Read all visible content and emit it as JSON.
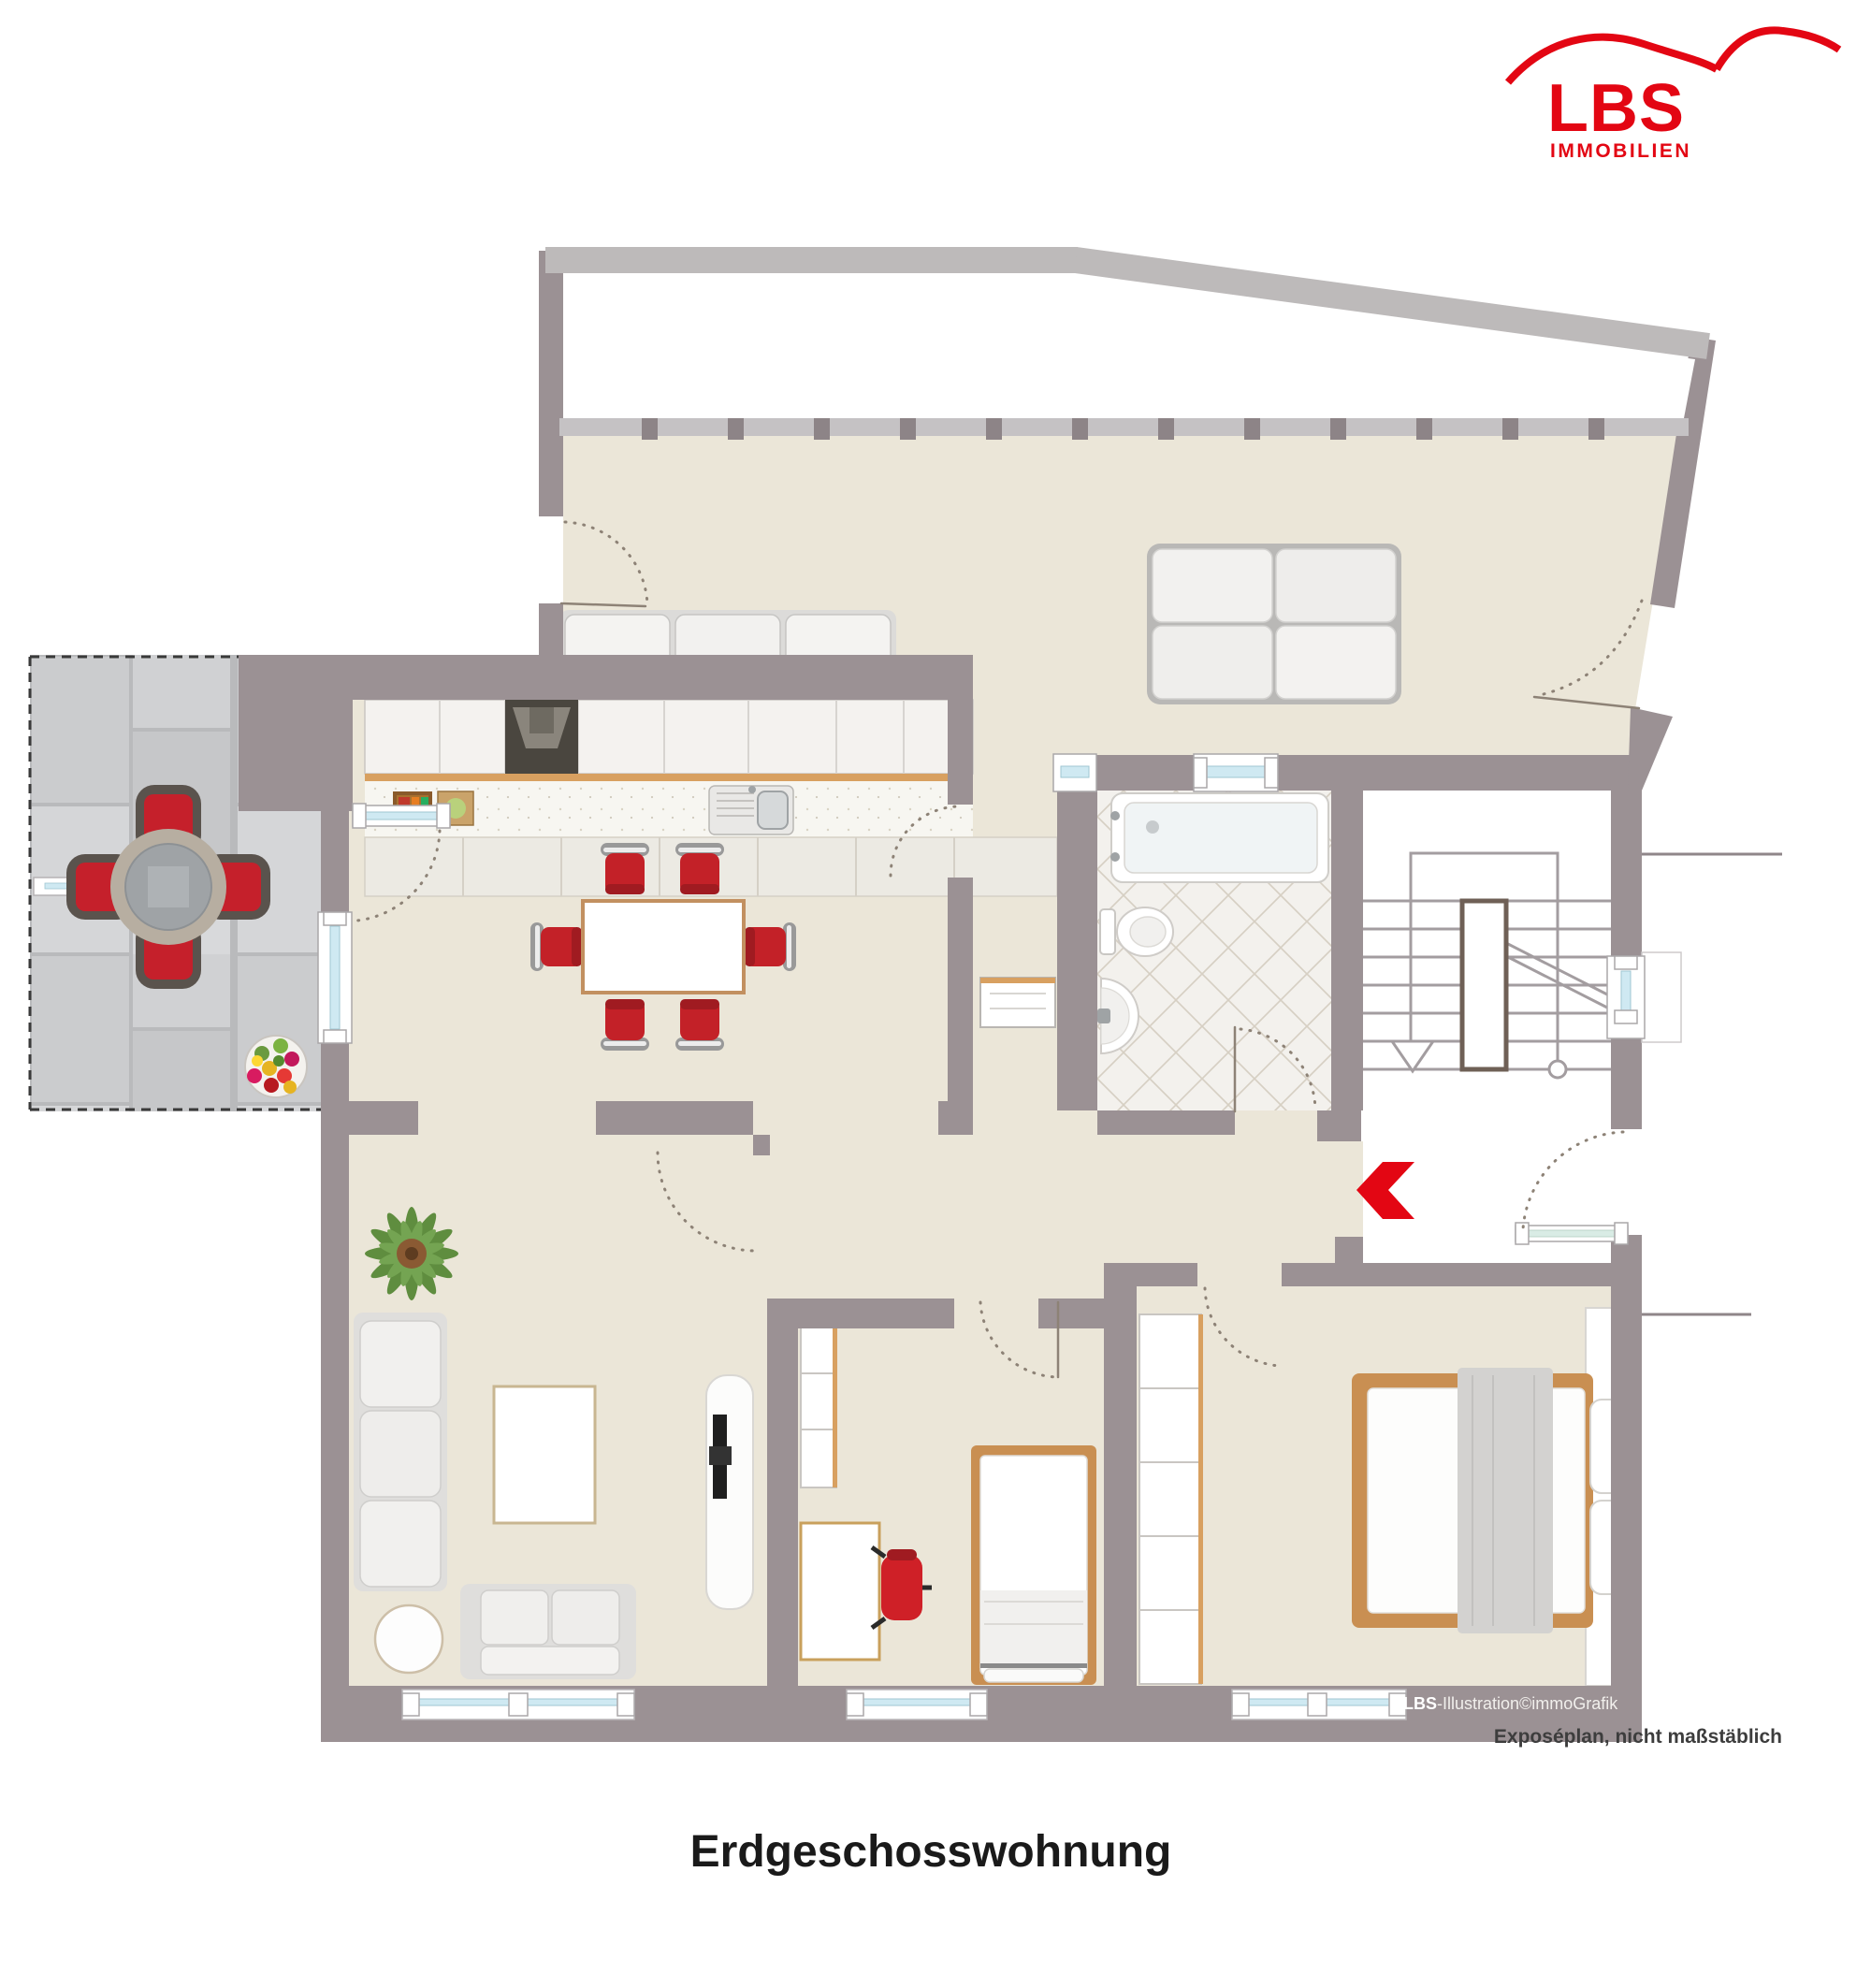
{
  "meta": {
    "title": "Erdgeschosswohnung"
  },
  "logo": {
    "name": "LBS",
    "sub": "IMMOBILIEN",
    "color": "#e30613",
    "icon": "roof-swoosh-icon"
  },
  "captions": {
    "credit_bold": "LBS",
    "credit_rest": "-Illustration©immoGrafik",
    "disclaimer": "Exposéplan, nicht maßstäblich"
  },
  "plan": {
    "type": "apartment-floor-plan",
    "floor_label": "Erdgeschosswohnung",
    "colors": {
      "wall": "#9b9194",
      "outer_wall_light": "#bdbaba",
      "floor_beige": "#ebe6d8",
      "terrace_tile": "#cbccce",
      "bath_tile": "#f3f1ed",
      "window_glass": "#cfe9f2",
      "accent_red": "#e30613",
      "chair_red": "#c32128",
      "wood": "#c98f52"
    },
    "areas": [
      "garden-terrace-top",
      "living-dining-room",
      "kitchen-line",
      "terrace-left",
      "bathroom",
      "staircase",
      "hallway",
      "living-room",
      "child-room",
      "bedroom"
    ],
    "furniture": [
      "sofa-3-seat-top",
      "sofa-2x2-lounge",
      "kitchen-counter",
      "extractor-stove",
      "kitchen-sink",
      "dining-table",
      "dining-chairs-red-x6",
      "terrace-round-table",
      "terrace-chairs-red-x4",
      "flower-pot",
      "bathtub",
      "toilet",
      "wash-basin",
      "stair-run",
      "sofa-3-seat-living",
      "sofa-2-seat-living",
      "side-table-round",
      "rug",
      "tv-sideboard",
      "potted-plant",
      "shelf-unit",
      "desk",
      "office-chair-red",
      "single-bed",
      "wardrobe",
      "double-bed",
      "entrance-arrow"
    ]
  }
}
